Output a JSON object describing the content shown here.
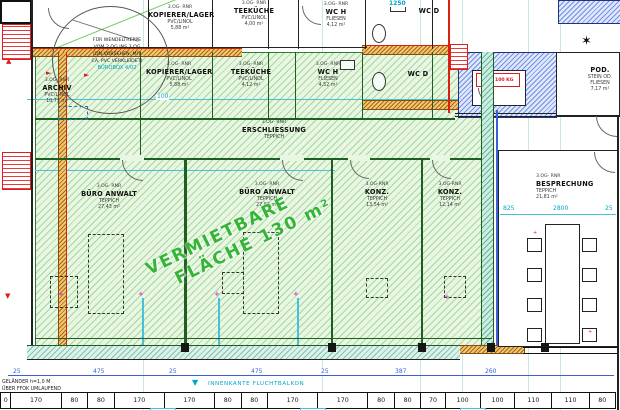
{
  "banner": {
    "line1": "VERMIETBARE",
    "line2": "FLÄCHE 130 m²"
  },
  "rooms": {
    "kop_top": {
      "prefix": "3.OG- RNR",
      "name": "KOPIERER/LAGER",
      "material": "PVC/LINOL",
      "area": "5,88 m²"
    },
    "tee_top": {
      "prefix": "3.OG- RNR",
      "name": "TEEKÜCHE",
      "material": "PVC/LINOL",
      "area": "4,00 m²"
    },
    "wch_top": {
      "prefix": "3.OG- RNR",
      "name": "WC H",
      "material": "FLIESEN",
      "area": "4,12 m²"
    },
    "wcd_top": {
      "name": "WC D"
    },
    "pod": {
      "name": "POD.",
      "material": "STEIN OD. FLIESEN",
      "area": "7,17 m²"
    },
    "archiv": {
      "prefix": "3.OG- RNR",
      "name": "ARCHIV",
      "material": "PVC/LINOL",
      "area": "10,73 m²"
    },
    "kop_green": {
      "prefix": "3.OG- RNR",
      "name": "KOPIERER/LAGER",
      "material": "PVC/LINOL",
      "area": "5,88 m²"
    },
    "tee_green": {
      "prefix": "3.OG- RNR",
      "name": "TEEKÜCHE",
      "material": "PVC/LINOL",
      "area": "4,12 m²"
    },
    "wch_green": {
      "prefix": "3.OG- RNR",
      "name": "WC H",
      "material": "FLIESEN",
      "area": "4,52 m²"
    },
    "wcd_green": {
      "name": "WC D"
    },
    "erschliessung": {
      "prefix": "3.OG- RNR",
      "name": "ERSCHLIESSUNG",
      "material": "TEPPICH"
    },
    "buero1": {
      "prefix": "3.OG- RNR",
      "name": "BÜRO ANWALT",
      "material": "TEPPICH",
      "area": "27,43 m²"
    },
    "buero2": {
      "prefix": "3.OG- RNR",
      "name": "BÜRO ANWALT",
      "material": "TEPPICH",
      "area": "27,83 m²"
    },
    "konz1": {
      "prefix": "3.OG-RNR",
      "name": "KONZ.",
      "material": "TEPPICH",
      "area": "13,54 m²"
    },
    "konz2": {
      "prefix": "3.OG-RNR",
      "name": "KONZ.",
      "material": "TEPPICH",
      "area": "12,14 m²"
    },
    "besprechung": {
      "prefix": "3.OG- RNR",
      "name": "BESPRECHUNG",
      "material": "TEPPICH",
      "area": "21,81 m²"
    }
  },
  "notes": {
    "wendel1": "FÜR WENDELTREPPE",
    "wendel2": "VOM 2.OG INS 3.OG",
    "wendel3": "(DN VORSEHEN, MIT",
    "wendel4": "CA. PVC VERKLEIDET)",
    "buerobox": "BÜROBOX 4/02",
    "lift": "LIFT 100 KG",
    "gelaender1": "GELÄNDER h=1,0 M",
    "gelaender2": "ÜBER FFOK UMLAUFEND",
    "fluchtbalkon": "INNENKANTE FLUCHTBALKON",
    "grid100": "100"
  },
  "icons": {
    "north": "✶",
    "triangle_down": "▼",
    "triangle_up": "▲",
    "arrow_right": "►",
    "plus_marker": "+"
  },
  "dims": {
    "top": "1250",
    "besp": [
      "825",
      "2800",
      "25"
    ],
    "main": [
      "25",
      "475",
      "25",
      "475",
      "25",
      "387",
      "260"
    ],
    "bottom": [
      "0",
      "170",
      "80",
      "80",
      "170",
      "170",
      "80",
      "80",
      "170",
      "170",
      "80",
      "80",
      "70",
      "100",
      "100",
      "110",
      "110",
      "80"
    ]
  },
  "colors": {
    "rentable_fill": "#e9f6e2",
    "hatch_green": "#60ba60",
    "border_green": "#1e5e20",
    "wall_orange": "#f2c969",
    "wall_blue": "#3a5fd9",
    "dim_cyan": "#00a7c4",
    "dim_blue": "#3a5fd9",
    "accent_red": "#e01b1b",
    "accent_magenta": "#cf3fcf",
    "banner_green": "#35b535"
  }
}
